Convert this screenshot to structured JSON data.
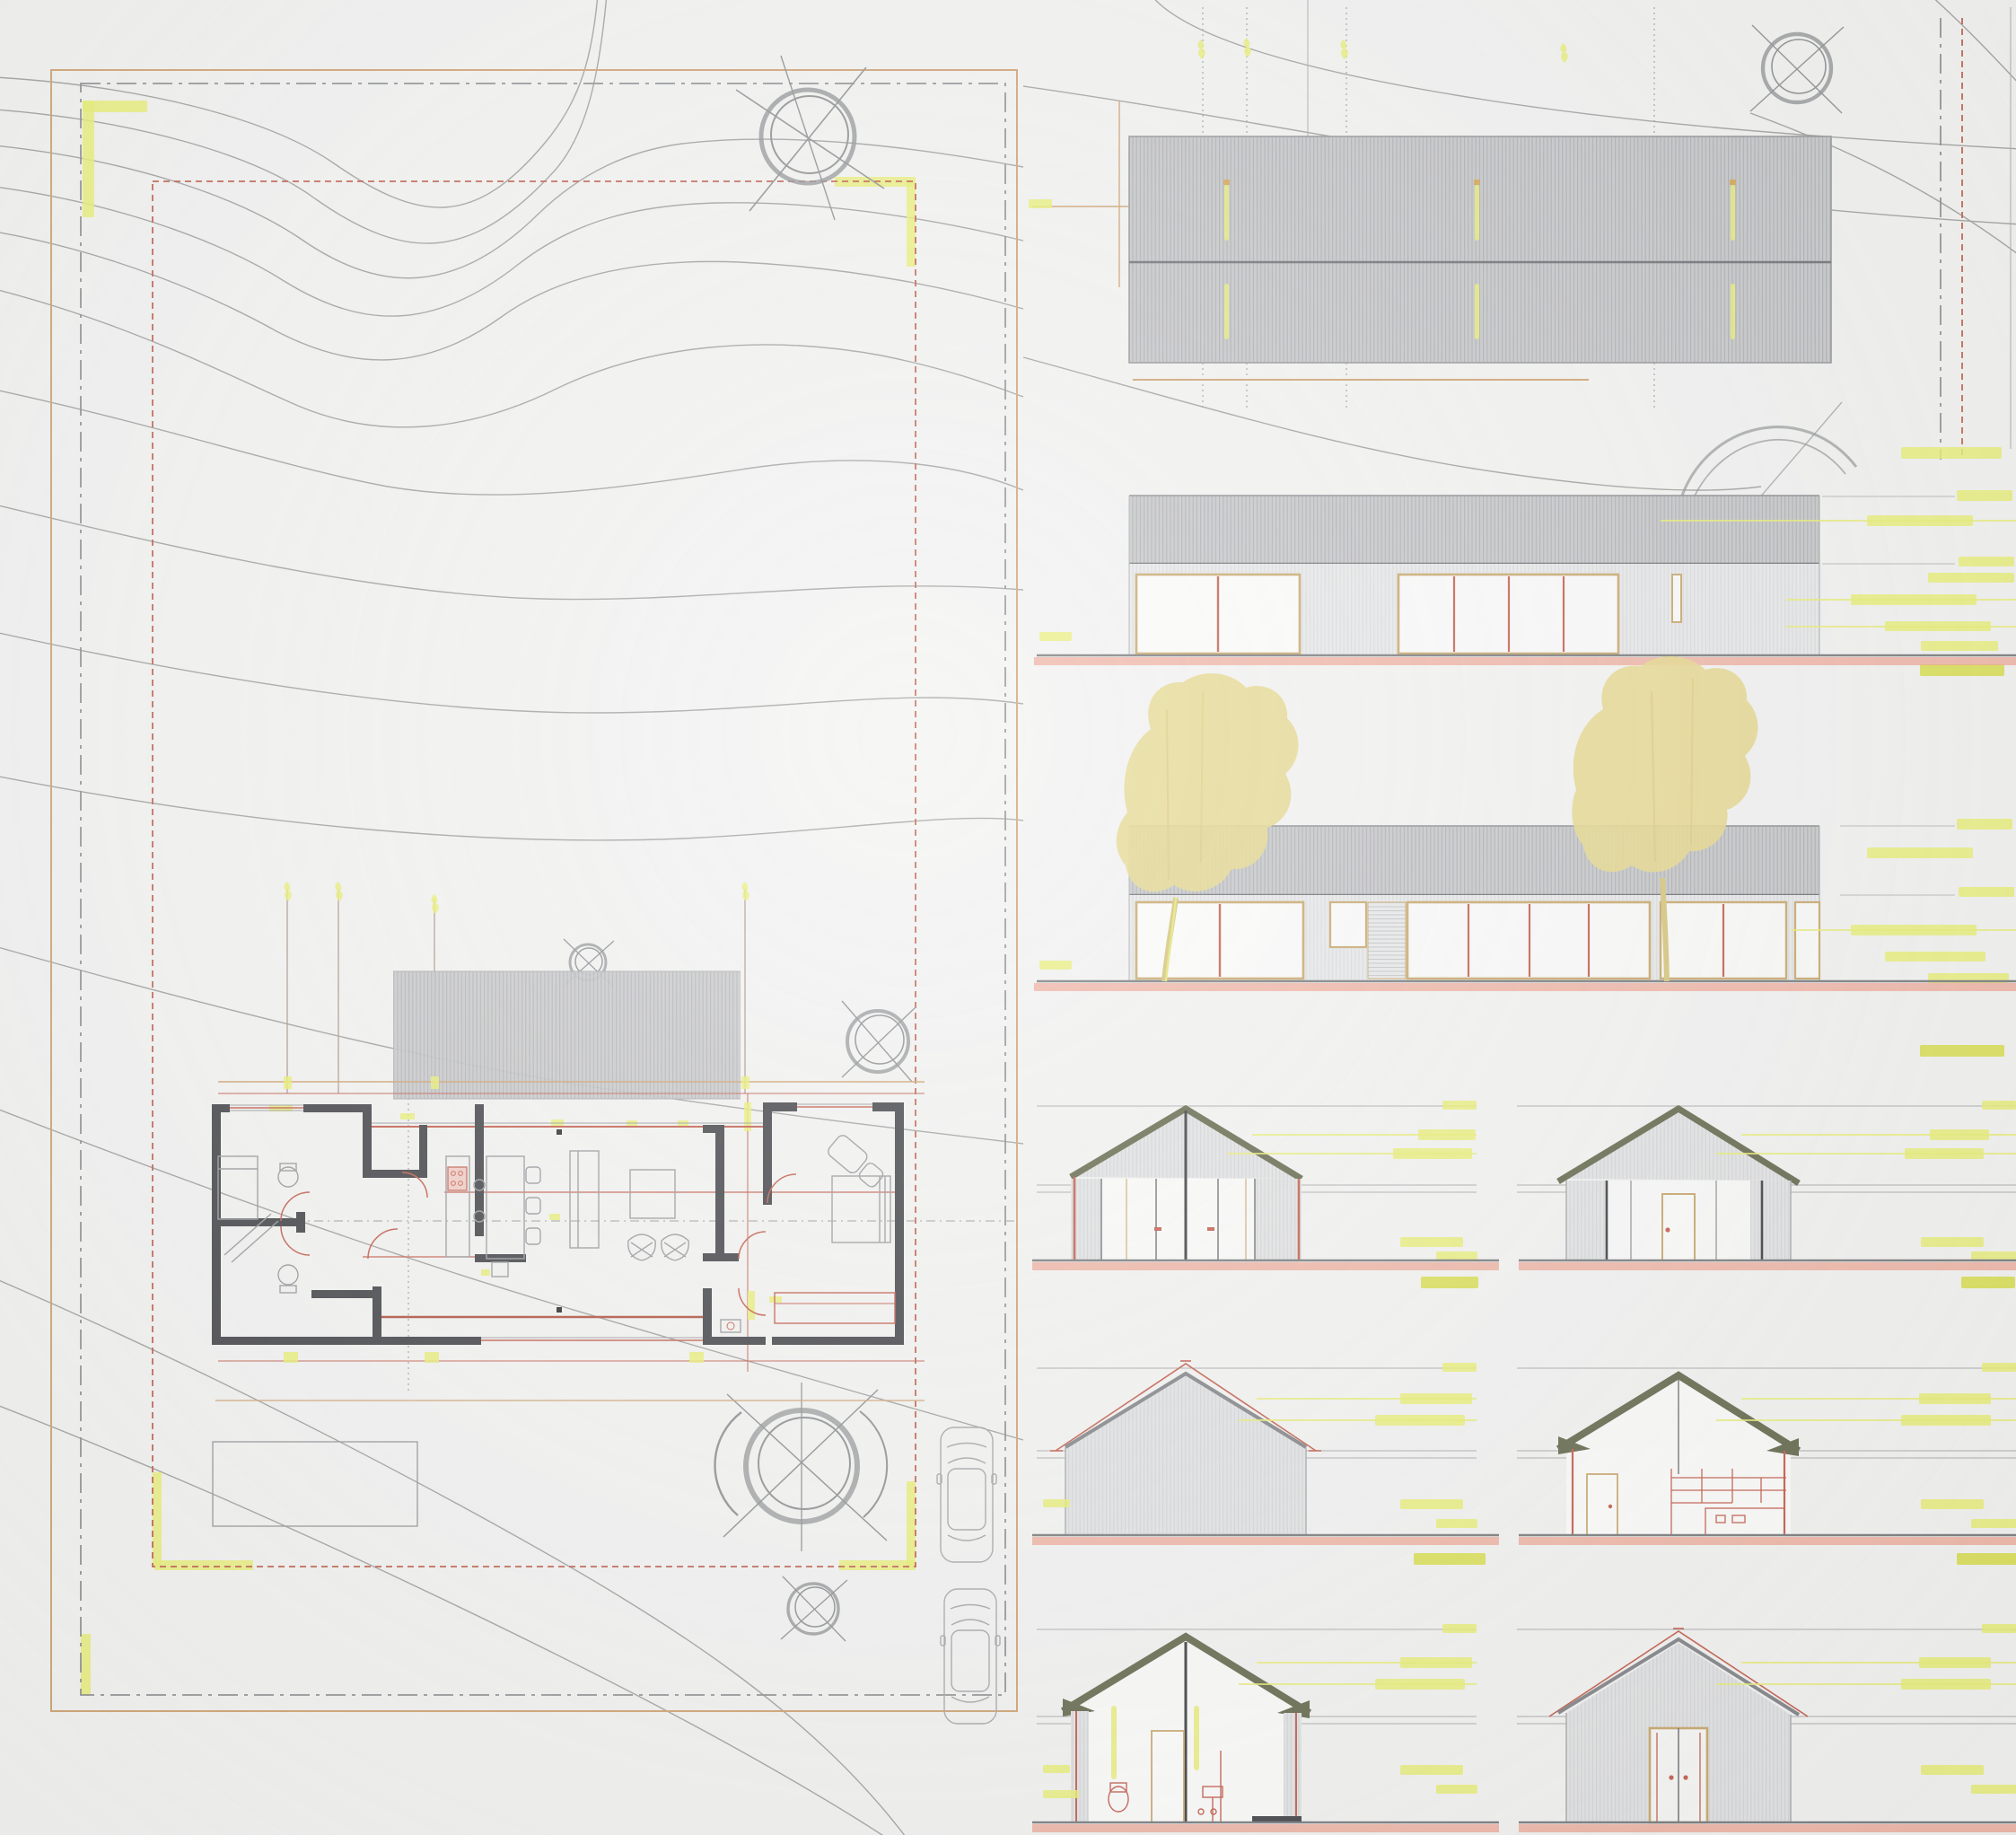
{
  "document": {
    "kind": "Architectural drawing sheet: site plan, roof plan, elevations and sections",
    "visible_text": "none (all dimension annotations are illegible yellow-highlighted CAD text)"
  },
  "palette": {
    "paper": "#f3f3f2",
    "contour": "#a2a2a1",
    "orange": "#cfa473",
    "dashdot": "#8f9092",
    "red": "#c0604c",
    "hl": "#e9ee75",
    "hlDark": "#d9df4e",
    "roofFill": "#c7c8ca",
    "roofHatch": "#adafb2",
    "roofEdge": "#6f7175",
    "wallFill": "#e8e9ea",
    "wallHatch": "#dadbdc",
    "wall2": "#e3e4e5",
    "hatch2": "#d4d5d7",
    "tan": "#c9a96e",
    "winRed": "#c4604f",
    "salmon": "#efa492",
    "groundLine": "#7b7c7e",
    "olive": "#676b4f",
    "dark": "#45464a",
    "furn": "#9b9c9f",
    "treeFill": "#e6d88e",
    "trunk": "#d6c67c",
    "sketch": "#8f9193",
    "planRed": "#c4604f",
    "planRedBold": "#b2543f"
  },
  "site_plan": {
    "boundary_layers": [
      "orange property line",
      "gray dash-dot line",
      "red dashed setback with yellow highlights"
    ],
    "tree_symbols": 5,
    "car_symbols": 2,
    "terrace_outline": true,
    "floor_plan_elements": [
      "bedrooms",
      "bathroom core",
      "kitchen island",
      "dining table",
      "sofa",
      "coffee table",
      "lounge chairs",
      "bed",
      "wardrobe",
      "entry",
      "door swings",
      "roof overhang hatch"
    ]
  },
  "drawings": [
    {
      "id": "roof-plan",
      "type": "roof plan with ridge line"
    },
    {
      "id": "elevation-long-1",
      "type": "long elevation, corrugated roof band, glazed openings"
    },
    {
      "id": "elevation-long-2",
      "type": "long elevation with two yellow trees"
    },
    {
      "id": "gable-elevation-1",
      "type": "glazed gable end elevation"
    },
    {
      "id": "gable-elevation-2",
      "type": "gable end elevation with door"
    },
    {
      "id": "gable-elevation-3",
      "type": "blank gable end elevation with red roof offset line"
    },
    {
      "id": "section-1",
      "type": "cross section with red kitchen joinery"
    },
    {
      "id": "section-2",
      "type": "cross section with red bathroom fixtures"
    },
    {
      "id": "gable-elevation-4",
      "type": "gable end elevation with red double door"
    }
  ],
  "annotations": {
    "style": "yellow highlighted dimension strings and level leaders",
    "legible": false
  }
}
